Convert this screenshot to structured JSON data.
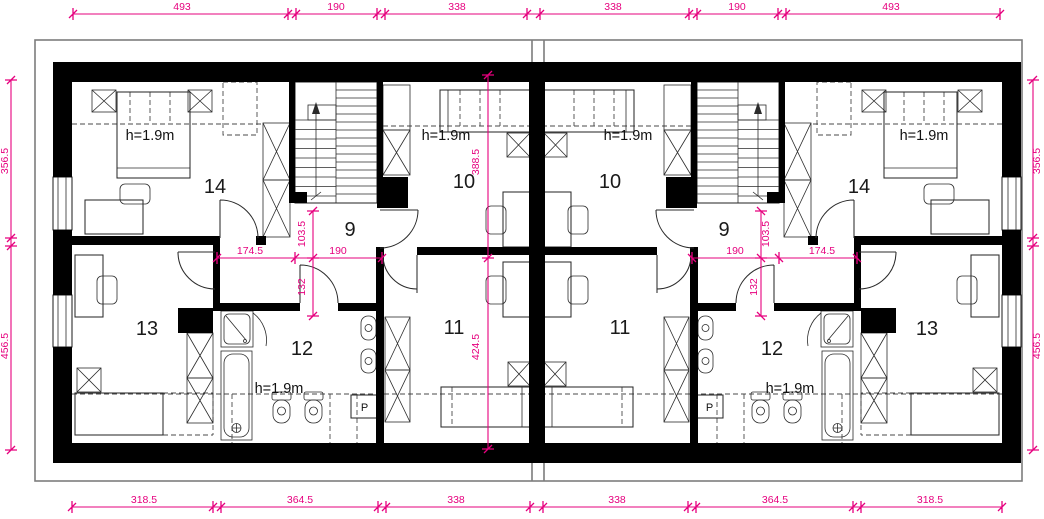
{
  "colors": {
    "dimension_magenta": "#e6007e",
    "wall_black": "#000000",
    "roof_outline_gray": "#7d7d7d"
  },
  "dims": {
    "top": [
      "493",
      "190",
      "338",
      "338",
      "190",
      "493"
    ],
    "bottom": [
      "318.5",
      "364.5",
      "338",
      "338",
      "364.5",
      "318.5"
    ],
    "side_left": [
      "356.5",
      "456.5"
    ],
    "side_right": [
      "356.5",
      "456.5"
    ],
    "inner_left": [
      "174.5",
      "190",
      "103.5",
      "132",
      "388.5",
      "424.5"
    ],
    "inner_right": [
      "190",
      "174.5",
      "103.5",
      "132"
    ]
  },
  "rooms": {
    "left": [
      "14",
      "9",
      "10",
      "13",
      "12",
      "11"
    ],
    "right": [
      "10",
      "9",
      "14",
      "11",
      "12",
      "13"
    ]
  },
  "labels": {
    "height": "h=1.9m",
    "washer": "P"
  }
}
